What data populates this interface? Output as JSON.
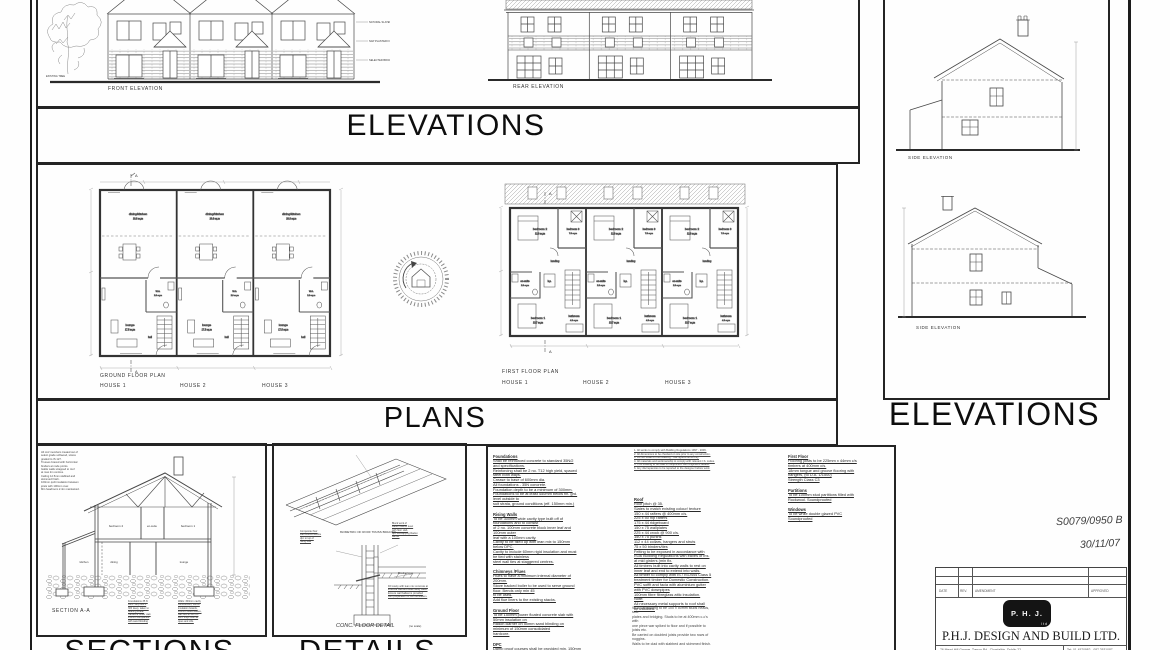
{
  "titles": {
    "elevations_top": "ELEVATIONS",
    "elevations_right": "ELEVATIONS",
    "plans": "PLANS",
    "sections": "SECTIONS",
    "details": "DETAILS"
  },
  "front_elevation": {
    "label": "FRONT ELEVATION",
    "tree_note": "EXISTING TREE",
    "notes": [
      "NATURAL SLATES",
      "NAP PLASTER FINISH",
      "SELECTED BRICK FINISH"
    ]
  },
  "rear_elevation": {
    "label": "REAR ELEVATION"
  },
  "side_elevations": {
    "label1": "SIDE ELEVATION",
    "label2": "SIDE ELEVATION"
  },
  "plans": {
    "section_marker": "A",
    "gf": {
      "title": "GROUND FLOOR PLAN",
      "houses": [
        "HOUSE 1",
        "HOUSE 2",
        "HOUSE 3"
      ],
      "dining": "dining/kitchen",
      "dining_area": "20.8 sq.m",
      "lounge": "lounge",
      "lounge_area": "17.5 sq.m",
      "wc": "w.c.",
      "wc_area": "2.0 sq.m",
      "hall": "hall"
    },
    "ff": {
      "title": "FIRST FLOOR PLAN",
      "houses": [
        "HOUSE 1",
        "HOUSE 2",
        "HOUSE 3"
      ],
      "bed2": "bedroom 2",
      "bed2_area": "12.9 sq.m",
      "bed3": "bedroom 3",
      "bed3_area": "7.0 sq.m",
      "landing": "landing",
      "ensuite": "en-suite",
      "ensuite_area": "2.8 sq.m",
      "hp": "h.p.",
      "bed1": "bedroom 1",
      "bed1_area": "13.7 sq.m",
      "bath": "bathroom",
      "bath_area": "4.3 sq.m"
    }
  },
  "section": {
    "label": "SECTION A-A",
    "rooms": {
      "bed2": "bedroom 2",
      "ensuite": "en-suite",
      "bed1": "bedroom 1",
      "kitchen": "kitchen",
      "dining": "dining",
      "lounge": "lounge"
    },
    "notes_top": [
      "All roof members treated out of",
      "select grade softwood, stress",
      "graded to IS 127.",
      "Trusses braced with horizontal",
      "binders at node points.",
      "Gable walls strapped to roof",
      "at max 2m centres.",
      "Ceiling 12.5mm slabbed and",
      "skimmed finish.",
      "100mm quilt insulation between",
      "joists with 100mm over.",
      "Min headroom 2.4m maintained."
    ],
    "notes_bl": [
      "Foundations 35 N",
      "conc. strip 900 x",
      "300 deep, taken to",
      "bearing strata.",
      "Hardcore under slab",
      "150mm compacted",
      "with sand blinding"
    ],
    "notes_br": [
      "Walls: 300mm cavity",
      "construction, 60mm",
      "insulation boards,",
      "100mm block leaves,",
      "wall ties at 450 c/s",
      "DPC trays over all",
      "opes and cills."
    ]
  },
  "details": {
    "iso_label": "ISOMETRIC OF ROOF TRUSS BRACING",
    "floor_label": "CONC. FLOOR DETAIL",
    "floor_label_note": "(no scale)",
    "left_note": [
      "Composite floor",
      "slab wound flexible",
      "dpc to top of",
      "rising wall"
    ],
    "right_note1": [
      "Block work of",
      "Radon barrier level",
      "with floor slab,",
      "dpc overlapping Radon",
      "Barrier"
    ],
    "right_note2": [
      "Blinding layer"
    ],
    "para": [
      "Fill cavity with lean mix concrete at",
      "external wall and seal cavity walls.",
      "Ensure wall ballast is provided",
      "with preparation of the foundation."
    ]
  },
  "specs": {
    "col1": [
      {
        "h": "Foundations",
        "lines": [
          "Shall be reinforced concrete to standard 35N/2",
          "and specifications.",
          "Reinforcing shall be 2 no. T12 high yield, spaced",
          "steel both ways.",
          "Crease to base of 600mm dia.",
          "All foundations - 35N concrete.",
          "Foundation depth to be a minimum of 300mm.",
          "Foundations to be at least 450mm below fin. grd.",
          "level outside to",
          "suit strata, ground conditions (eff. 150mm min.)"
        ]
      },
      {
        "h": "Rising Walls",
        "lines": [
          "To be 300mm wide cavity type built off of",
          "foundations and to consist",
          "of 2 no. 100mm concrete block inner leaf and",
          "100mm outer",
          "leaf with a 100mm cavity.",
          "Cavity to be filled up with lean mix to 150mm",
          "below DPC.",
          "Cavity to include 60mm rigid insulation and must",
          "be tied with stainless",
          "steel wall ties at staggered centres."
        ]
      },
      {
        "h": "Chimneys /Flues",
        "lines": [
          "Flues to have a minimum internal diameter of",
          "200mm.",
          "Stove backed boiler to be used to serve ground",
          "floor. Bends only min 45",
          "to be used.",
          "Add flue liners to the existing stacks."
        ]
      },
      {
        "h": "Ground Floor",
        "lines": [
          "To be 150mm power floated concrete slab with",
          "50mm insulation on",
          "Radon Barrier on 50mm sand blinding on",
          "minimum of 150mm consolidated",
          "hardcore."
        ]
      },
      {
        "h": "DPC",
        "lines": [
          "Damp proof courses shall be provided min. 150mm",
          "above finished paving / ground levels to",
          "external walls based to"
        ]
      }
    ],
    "col2_notes": [
      "1. All works to comply with Building Regulations 1997 - 2006.",
      "2. All dimensions to be checked on site prior to any construction.",
      "3. Do not scale off this drawing - use figured dims only.",
      "4. All materials and workmanship to comply with relevant I.S. codes.",
      "5. This drawing to be read in conjunction with engineers details.",
      "6. Any discrepancies to be reported to the designer before work."
    ],
    "col2": [
      {
        "h": "Roof",
        "lines": [
          "Roof pitch @ 35.",
          "Slates to match existing colour/ texture",
          "150 x 44 rafters @ 400mm c/s.",
          "225 x 50 hip rafters",
          "175 x 44 ridgeboard",
          "150 x 75 wallplates",
          "225 x 44 crock @ 900 c/s.",
          "150 x 75 purlins",
          "112 x 44 collars, hangers and struts",
          "75 x 50 binders/ties",
          "Felting to be exposed in accordance with",
          "IS36 Building Regulations with eaves of ins.",
          "at mid girders (min fix.",
          "All timbers built into cavity walls to rest on",
          "inner leaf and end to extend into walls.",
          "All timber to comply with IS / ISO444 Class 5",
          "treatment timber for Domestic Construction.",
          "PVC soffit and facia with aluminium gutter",
          "with PVC downpipes",
          "100mm fibre fibreglass attic insulation.",
          "Note:",
          "All necessary metal supports to roof shall",
          "be included."
        ]
      }
    ],
    "col2_para": [
      "Stud partitioning to be 100 x 50mm studs heads,",
      "sole",
      "plates and bridging. Studs to be at 400mm c-c's",
      "with",
      "one piece war spiked to floor and if possible to",
      "joists etc.",
      "Be carried on doubled joists provide two rows of",
      "noggins.",
      "Walls to be clad with slabbed and skimmed finish."
    ],
    "col3": [
      {
        "h": "First Floor",
        "lines": [
          "Flooring joists to be 225mm x 44mm c/s",
          "timbers at 400mm c/s.",
          "18mm tongue and groove flooring with",
          "hangers, (to D.A. 1/1500)",
          "Strength Class C3"
        ]
      },
      {
        "h": "Partitions",
        "lines": [
          "To be 100mm stud partitions filled with",
          "Rockwool. Soundproofed"
        ]
      },
      {
        "h": "Windows",
        "lines": [
          "To be white double glazed PVC",
          "Soundproofed"
        ]
      }
    ]
  },
  "annotations": {
    "job_no": "S0079/0950 B",
    "date": "30/11/07"
  },
  "title_block": {
    "headers": [
      "DATE",
      "REV.",
      "AMENDMENT",
      "APPROVED"
    ],
    "logo": "P. H. J.",
    "logo_sub": "ltd",
    "company": "P.H.J. DESIGN AND BUILD LTD.",
    "address": "76 Mead Hill Grange, Tymon Rd., Clondalkin, Dublin 22",
    "phone": "Tel: 01 4570982 - 087 2531087"
  }
}
